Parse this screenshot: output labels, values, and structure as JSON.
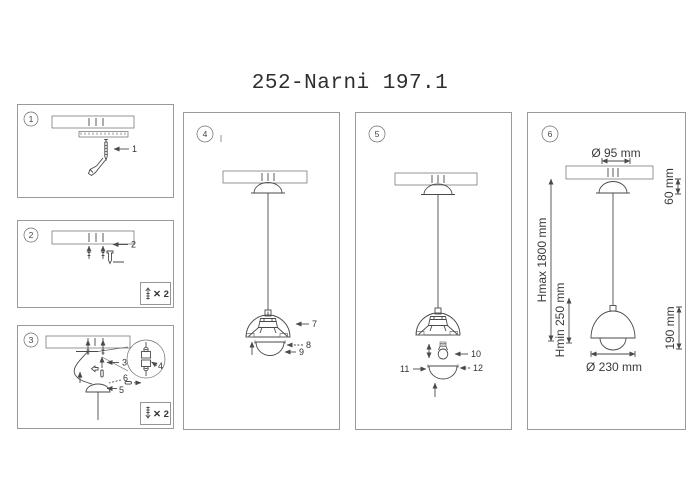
{
  "title": "252-Narni 197.1",
  "colors": {
    "line": "#4a4a4a",
    "panel_border": "#9a9a9a",
    "text": "#333333"
  },
  "panels": {
    "step1": {
      "badge": "1",
      "labels": {
        "screw": "1"
      }
    },
    "step2": {
      "badge": "2",
      "labels": {
        "screws": "2"
      },
      "corner_note": "✕ 2"
    },
    "step3": {
      "badge": "3",
      "labels": {
        "strain_relief": "3",
        "terminal_block": "4",
        "canopy": "5",
        "grub_screw": "6"
      },
      "corner_note": "✕ 2"
    },
    "step4": {
      "badge": "4",
      "labels": {
        "shade": "7",
        "glass_ring": "8",
        "diffuser": "9"
      }
    },
    "step5": {
      "badge": "5",
      "labels": {
        "bulb": "10",
        "diffuser": "11",
        "glass_ring": "12"
      }
    },
    "step6": {
      "badge": "6",
      "dims": {
        "canopy_diameter": "Ø 95 mm",
        "canopy_height": "60 mm",
        "max_height": "Hmax 1800 mm",
        "min_height": "Hmin 250 mm",
        "shade_height": "190 mm",
        "shade_diameter": "Ø 230 mm"
      }
    }
  }
}
